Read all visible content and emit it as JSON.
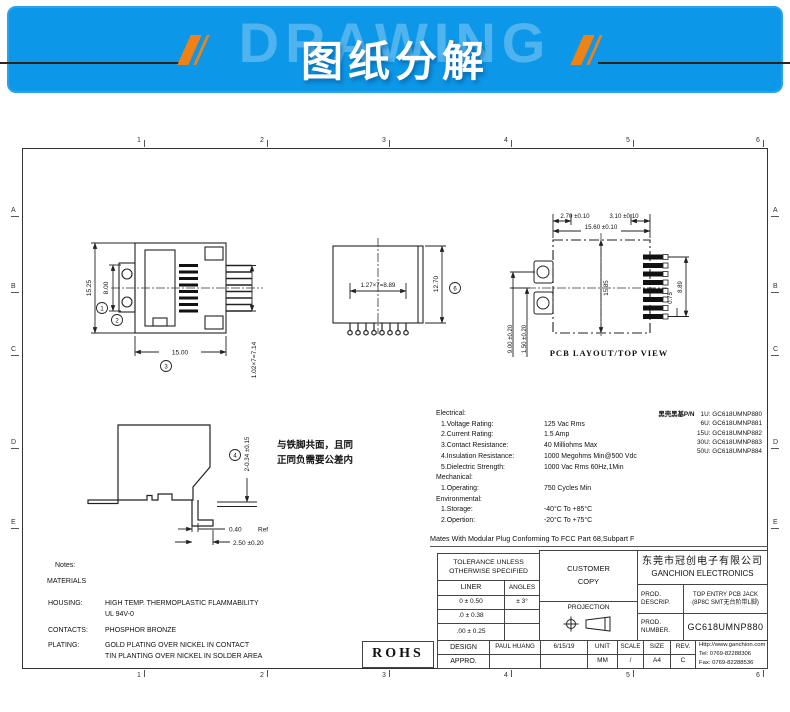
{
  "colors": {
    "banner_blue": "#0d97e8",
    "accent_orange": "#ee8216"
  },
  "banner": {
    "watermark": "DRAWING",
    "title": "图纸分解"
  },
  "zones": {
    "cols": [
      "1",
      "2",
      "3",
      "4",
      "5",
      "6"
    ],
    "rows": [
      "A",
      "B",
      "C",
      "D",
      "E"
    ]
  },
  "front_view": {
    "dim_height": "15.25",
    "dim_inner": "8.00",
    "dim_width": "15.00",
    "dim_pins": "1.02×7=7.14",
    "balloon_1": "1",
    "balloon_2": "2",
    "balloon_3": "3"
  },
  "bottom_view": {
    "dim_pitch": "1.27×7=8.89",
    "dim_height": "12.70",
    "balloon_6": "6"
  },
  "pcb_view": {
    "dim_a": "2.70 ±0.10",
    "dim_b": "3.10 ±0.10",
    "dim_c": "15.60 ±0.10",
    "dim_d": "15.85",
    "dim_e": "0.75",
    "dim_f": "8.89",
    "dim_g": "9.00 ±0.20",
    "dim_h": "1.50 ±0.20",
    "caption": "PCB LAYOUT/TOP VIEW"
  },
  "side_view": {
    "balloon_4": "4",
    "dim_a": "2-0.34 ±0.15",
    "dim_b": "0.40",
    "dim_b_ref": "Ref",
    "dim_c": "2.50 ±0.20",
    "note_line1": "与铁脚共面，且同",
    "note_line2": "正同负需要公差内"
  },
  "specs": {
    "lines": [
      {
        "label": "Electrical:",
        "value": ""
      },
      {
        "label": "1.Voltage Rating:",
        "value": "125 Vac Rms"
      },
      {
        "label": "2.Current Rating:",
        "value": "1.5 Amp"
      },
      {
        "label": "3.Contact Resistance:",
        "value": "40 Milliohms Max"
      },
      {
        "label": "4.Insulation Resistance:",
        "value": "1000 Megohms Min@500 Vdc"
      },
      {
        "label": "5.Dielectric Strength:",
        "value": "1000 Vac Rms 60Hz,1Min"
      },
      {
        "label": "Mechanical:",
        "value": ""
      },
      {
        "label": "1.Operating:",
        "value": "750 Cycles Min"
      },
      {
        "label": "Environmental:",
        "value": ""
      },
      {
        "label": "1.Storage:",
        "value": "-40°C To +85°C"
      },
      {
        "label": "2.Opertion:",
        "value": "-20°C To +75°C"
      }
    ],
    "mates": "Mates With Modular Plug Conforming To FCC Part 68,Subpart F"
  },
  "pn_list": {
    "title": "黑壳黑基P/N",
    "items": [
      "1U: GC618UMNP880",
      "6U: GC618UMNP881",
      "15U: GC618UMNP882",
      "30U: GC618UMNP883",
      "50U: GC618UMNP884"
    ]
  },
  "notes": {
    "heading": "Notes:",
    "materials": "MATERIALS",
    "housing_label": "HOUSING:",
    "housing_1": "HIGH TEMP. THERMOPLASTIC FLAMMABILITY",
    "housing_2": "UL 94V-0",
    "contacts_label": "CONTACTS:",
    "contacts_value": "PHOSPHOR BRONZE",
    "plating_label": "PLATING:",
    "plating_1": "GOLD PLATING OVER NICKEL IN CONTACT",
    "plating_2": "TIN PLANTING OVER NICKEL IN SOLDER AREA"
  },
  "title_block": {
    "tolerance_1": "TOLERANCE UNLESS",
    "tolerance_2": "OTHERWISE SPECIFIED",
    "liner": "LINER",
    "angles": "ANGLES",
    "tol_rows": [
      [
        "0 ± 0.50",
        "± 3°"
      ],
      [
        ".0 ± 0.38",
        ""
      ],
      [
        ".00 ± 0.25",
        ""
      ]
    ],
    "customer_1": "CUSTOMER",
    "customer_2": "COPY",
    "projection": "PROJECTION",
    "company_cn": "东莞市冠创电子有限公司",
    "company_en": "GANCHION ELECTRONICS",
    "prod_label": "PROD.",
    "descrip_label": "DESCRIP.",
    "descrip_1": "TOP ENTRY PCB JACK",
    "descrip_2": "(8P8C SMT无台阶带L脚)",
    "number_label_1": "PROD.",
    "number_label_2": "NUMBER.",
    "prod_number": "GC618UMNP880",
    "design": "DESIGN",
    "appro": "APPRO.",
    "designer": "PAUL HUANG",
    "date": "6/15/19",
    "unit_label": "UNIT",
    "unit": "MM",
    "scale_label": "SCALE",
    "scale": "/",
    "size_label": "SIZE",
    "size": "A4",
    "rev_label": "REV.",
    "rev": "C",
    "web": "Http://www.ganchion.com",
    "tel": "Tel:  0769-82288306",
    "fax": "Fax: 0769-82288536",
    "rohs": "ROHS"
  }
}
